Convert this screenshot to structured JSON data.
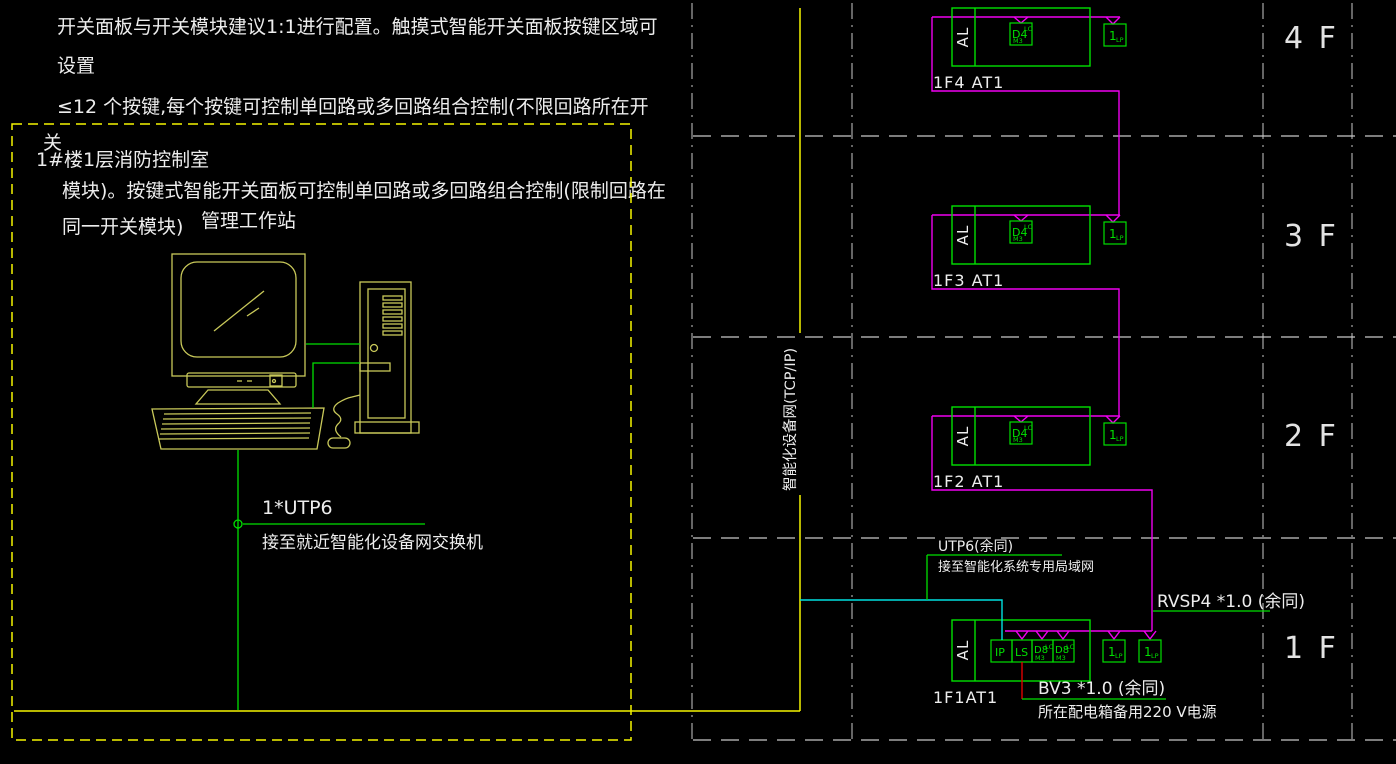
{
  "notes": {
    "line1": "开关面板与开关模块建议1:1进行配置。触摸式智能开关面板按键区域可",
    "line2": "设置",
    "line3": "≤12 个按键,每个按键可控制单回路或多回路组合控制(不限回路所在开",
    "line4": "关",
    "line5": "模块)。按键式智能开关面板可控制单回路或多回路组合控制(限制回路在",
    "line6": "同一开关模块)"
  },
  "control_room": {
    "title": "1#楼1层消防控制室",
    "workstation_label": "管理工作站",
    "cable_label": "1*UTP6",
    "cable_note": "接至就近智能化设备网交换机"
  },
  "riser_label": "智能化设备网(TCP/IP)",
  "floors": [
    {
      "name": "4 F",
      "panel": "1F4 AT1"
    },
    {
      "name": "3 F",
      "panel": "1F3 AT1"
    },
    {
      "name": "2 F",
      "panel": "1F2 AT1"
    },
    {
      "name": "1 F",
      "panel": "1F1AT1"
    }
  ],
  "devices": {
    "al": "AL",
    "dimmer": "D4",
    "dimmer_sub": "LC",
    "dimmer_sub2": "M3",
    "panel": "1",
    "panel_sub": "LP",
    "ip": "IP",
    "ls": "LS",
    "relay": "D8"
  },
  "wiring": {
    "utp6": "UTP6(余同)",
    "utp6_note": "接至智能化系统专用局域网",
    "rvsp4": "RVSP4 *1.0 (余同)",
    "bv3": "BV3 *1.0 (余同)",
    "bv3_note": "所在配电箱备用220 V电源"
  },
  "colors": {
    "bus_magenta": "#f000f0",
    "device_green": "#00e000",
    "trunk_yellow": "#f5f500",
    "lan_cyan": "#00e0e0",
    "power_red": "#e00000",
    "drawing_yellow": "#c9c95a"
  }
}
